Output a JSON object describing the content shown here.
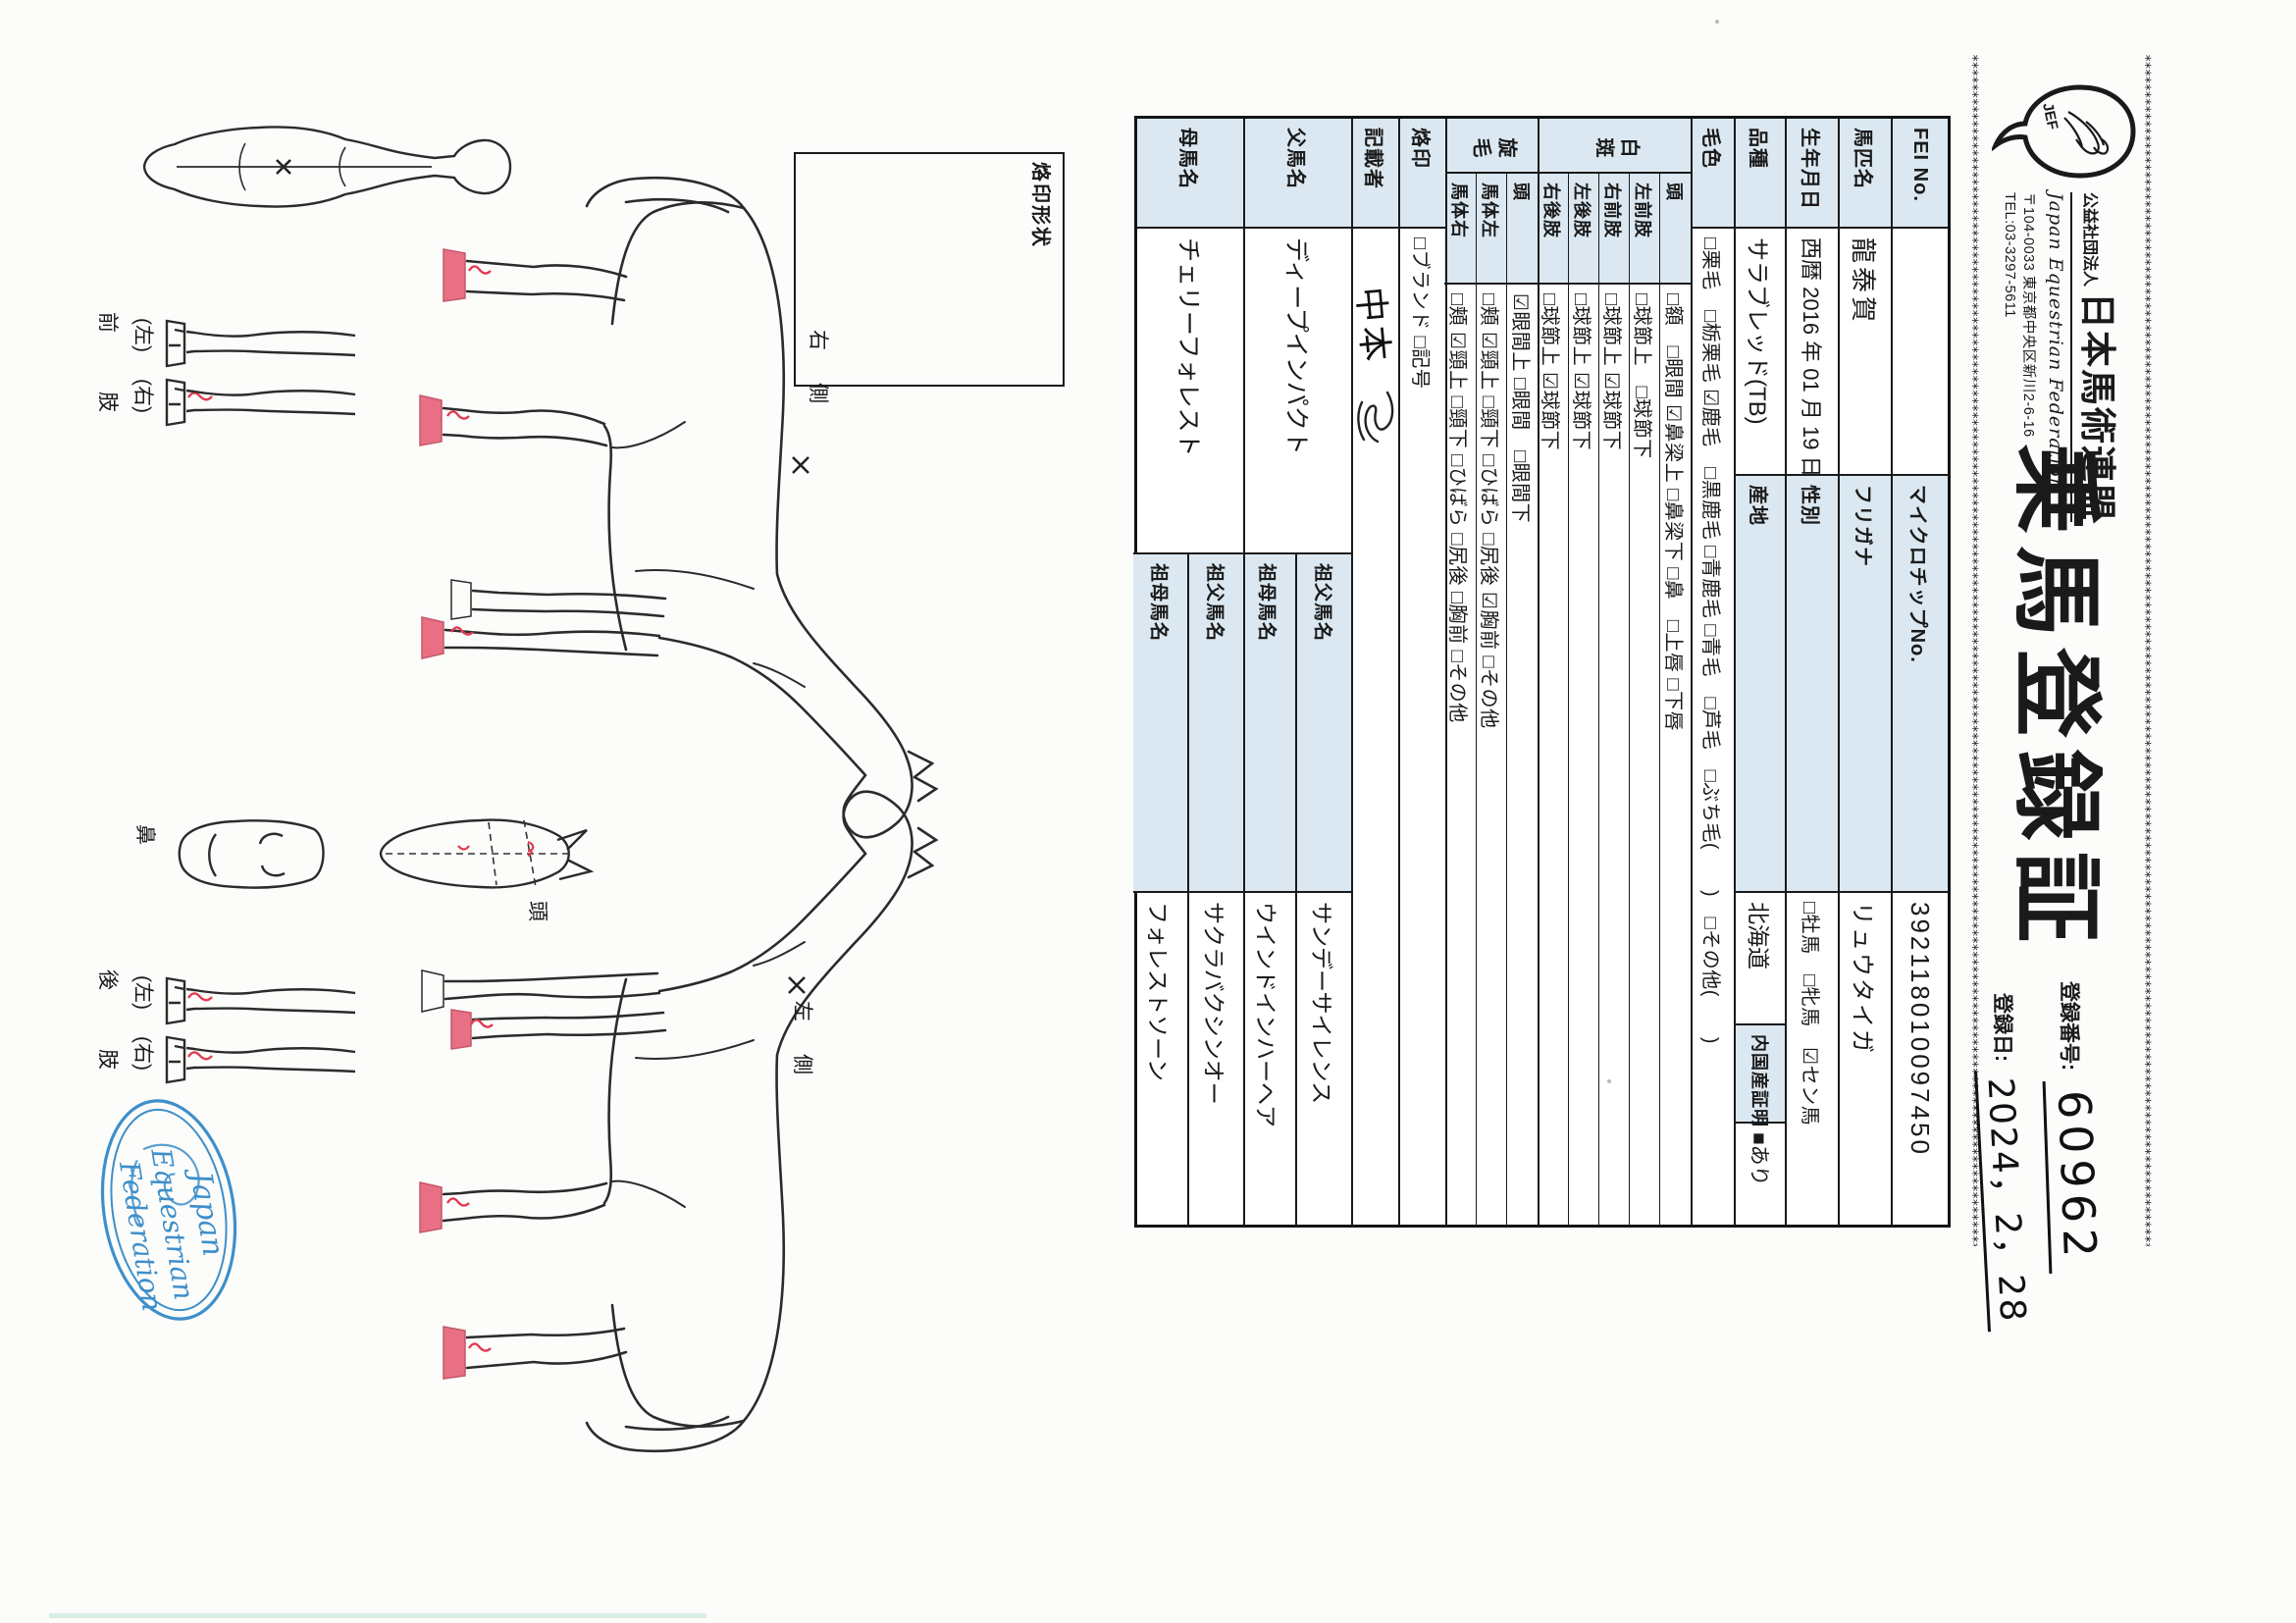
{
  "header": {
    "org_small": "公益社団法人",
    "org_large": "日本馬術連盟",
    "org_en": "Japan Equestrian Federation",
    "address": "〒104-0033 東京都中央区新川2-6-16",
    "tel": "TEL:03-3297-5611",
    "logo_text": "JEF",
    "title": "乗馬登録証",
    "reg_no_label": "登録番号:",
    "reg_no": "60962",
    "reg_date_label": "登録日:",
    "reg_date": "2024，2，28"
  },
  "table": {
    "r1": {
      "label": "FEI No.",
      "value": "",
      "label2": "マイクロチップNo.",
      "value2": "392118010097450"
    },
    "r2": {
      "label": "馬匹名",
      "value": "龍泰賀",
      "label2": "フリガナ",
      "value2": "リュウタイガ"
    },
    "r3": {
      "label": "生年月日",
      "value": "西暦 2016 年 01 月 19 日 生",
      "label2": "性別",
      "value2": "□牡馬　□牝馬　☑セン馬"
    },
    "r4": {
      "label": "品種",
      "value": "サラブレッド(TB)",
      "label2": "産地",
      "value2": "北海道",
      "label3": "内国産証明",
      "value3": "■あり"
    },
    "r5": {
      "label": "毛色",
      "value": "□栗毛　□栃栗毛 ☑鹿毛　□黒鹿毛 □青鹿毛 □青毛　□芦毛　□ぶち毛(　　)　□その他(　　)"
    },
    "hakuhan": {
      "group": "白斑",
      "head": {
        "label": "頭",
        "value": "□額　□眼間 ☑鼻梁上 □鼻梁下 □鼻　□上唇 □下唇"
      },
      "lf": {
        "label": "左前肢",
        "value": "□球節上　□球節下"
      },
      "rf": {
        "label": "右前肢",
        "value": "□球節上 ☑球節下"
      },
      "lh": {
        "label": "左後肢",
        "value": "□球節上 ☑球節下"
      },
      "rh": {
        "label": "右後肢",
        "value": "□球節上 ☑球節下"
      }
    },
    "senmou": {
      "group": "旋毛",
      "head": {
        "label": "頭",
        "value": "☑眼間上 □眼間　□眼間下"
      },
      "bodyl": {
        "label": "馬体左",
        "value": "□頬 ☑頸上 □頸下 □ひばら □尻後 ☑胸前 □その他"
      },
      "bodyr": {
        "label": "馬体右",
        "value": "□頬 ☑頸上 □頸下 □ひばら □尻後 □胸前 □その他"
      }
    },
    "r8": {
      "label": "烙印",
      "value": "□ブランド □記号"
    },
    "r9": {
      "label": "記載者",
      "value": "中本"
    },
    "r10": {
      "label": "父馬名",
      "value": "ディープインパクト",
      "gf_label": "祖父馬名",
      "gf": "サンデーサイレンス",
      "gm_label": "祖母馬名",
      "gm": "ウインドインハーヘア"
    },
    "r11": {
      "label": "母馬名",
      "value": "チェリーフォレスト",
      "gf_label": "祖父馬名",
      "gf": "サクラバクシンオー",
      "gm_label": "祖母馬名",
      "gm": "フォレストソーン"
    }
  },
  "diagram": {
    "brand_box": "烙印形状",
    "right_side": "右　側",
    "left_side": "左　側",
    "head": "頭",
    "nose": "鼻",
    "front_limb": "前　　肢",
    "hind_limb": "後　　肢",
    "paren_left": "(左)",
    "paren_right": "(右)"
  },
  "stamp": {
    "line1": "Japan",
    "line2": "Equestrian",
    "line3": "Federation"
  },
  "colors": {
    "label_blue": "#dbe8f1",
    "stamp_blue": "#3e8fca",
    "mark_red": "#e23a52",
    "hoof_pink": "#e97084"
  }
}
